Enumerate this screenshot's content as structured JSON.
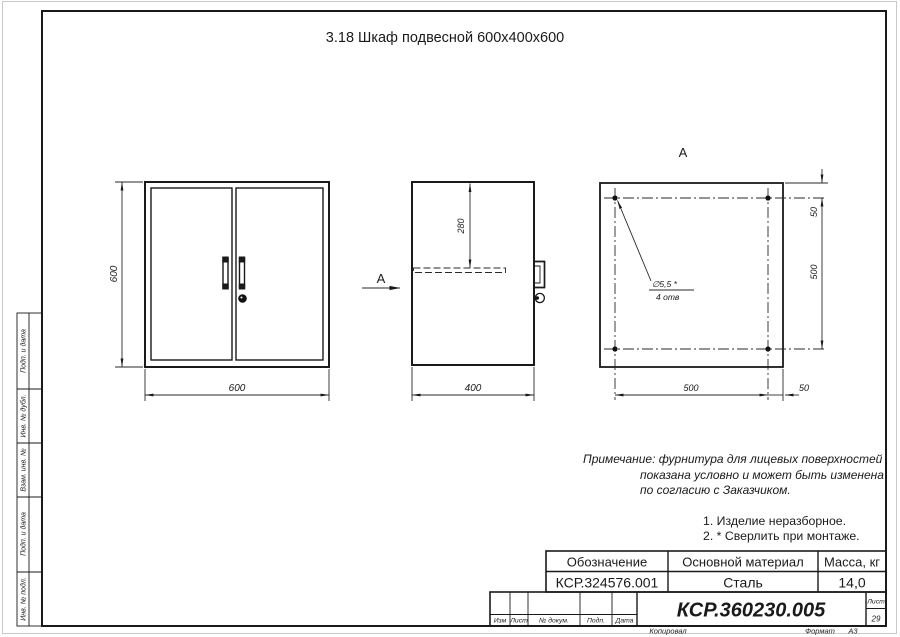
{
  "title": "3.18 Шкаф подвесной 600х400х600",
  "views": {
    "front": {
      "dim_height": "600",
      "dim_width": "600"
    },
    "side": {
      "dim_width": "400",
      "dim_shelf": "280",
      "section_label": "А"
    },
    "top": {
      "label": "А",
      "dim_right_top": "50",
      "dim_right_mid": "500",
      "dim_bottom_left": "500",
      "dim_bottom_right": "50",
      "hole_dia": "∅5,5 *",
      "hole_count": "4 отв"
    }
  },
  "note": {
    "line1": "Примечание: фурнитура для лицевых поверхностей",
    "line2": "показана условно и может быть изменена",
    "line3": "по согласию с Заказчиком."
  },
  "tech_notes": {
    "item1": "1. Изделие неразборное.",
    "item2": "2. * Сверлить при монтаже."
  },
  "title_block": {
    "col1_header": "Обозначение",
    "col2_header": "Основной материал",
    "col3_header": "Масса, кг",
    "designation": "КСР.324576.001",
    "material": "Сталь",
    "mass": "14,0",
    "doc_number": "КСР.360230.005",
    "sheet_label": "Лист",
    "sheet_number": "29",
    "row_labels": {
      "izm": "Изм",
      "list": "Лист",
      "doc": "№ докум.",
      "podp": "Подп.",
      "data": "Дата"
    },
    "footer": {
      "kopiroval": "Копировал",
      "format_label": "Формат",
      "format_value": "А3"
    }
  },
  "side_stamps": [
    "Подп. и дата",
    "Инв. № дубл.",
    "Взам. инв. №",
    "Подп. и дата",
    "Инв. № подл."
  ],
  "colors": {
    "line": "#1a1a1a",
    "paper": "#ffffff"
  }
}
